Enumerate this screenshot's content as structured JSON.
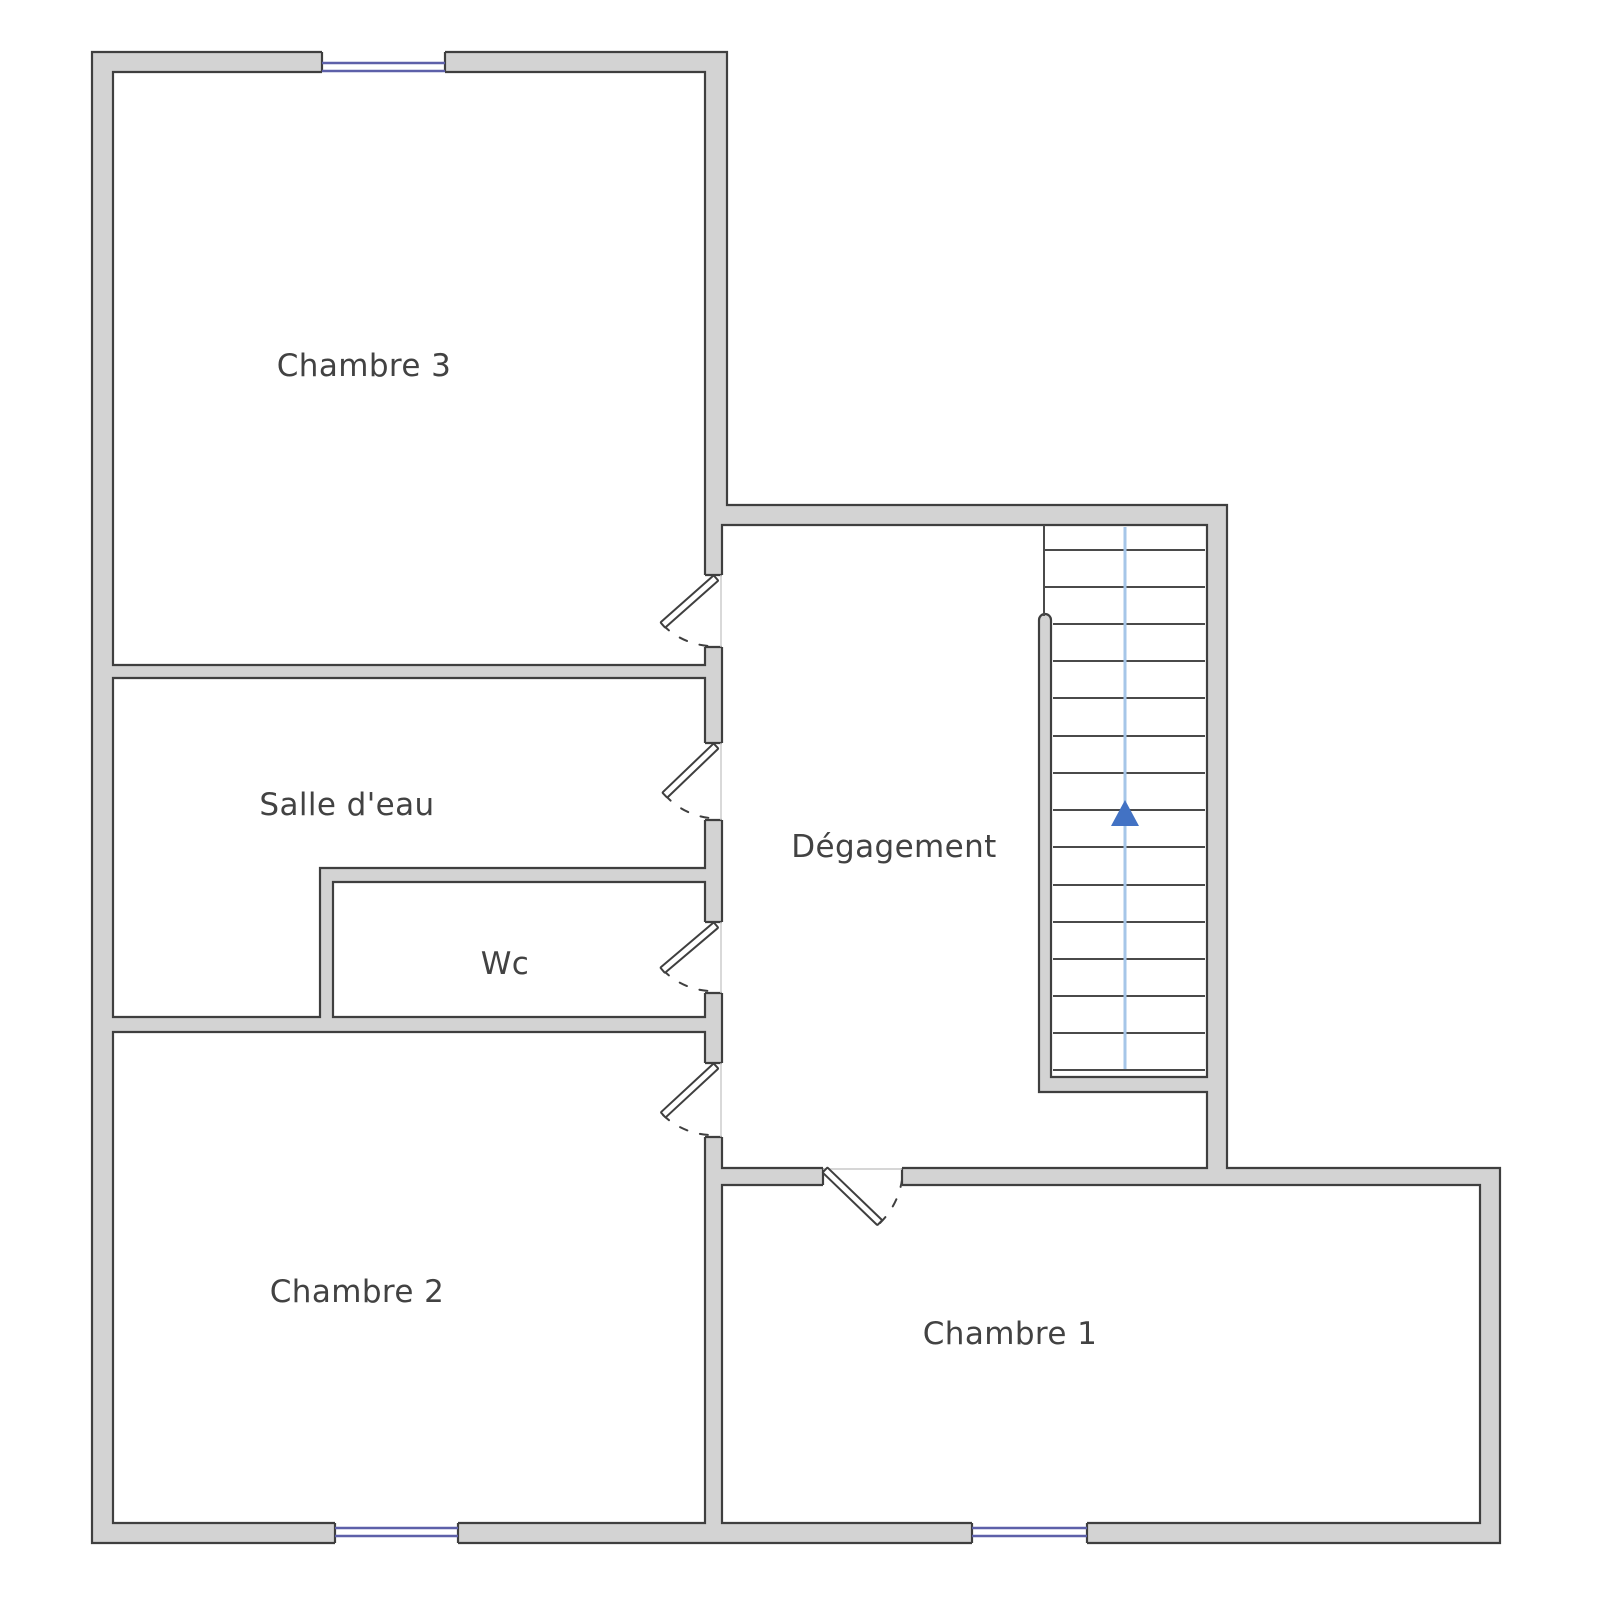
{
  "meta": {
    "title": "Floor plan - upper storey",
    "background": "#ffffff"
  },
  "colors": {
    "wall_fill": "#d3d3d3",
    "wall_stroke": "#3f3f3f",
    "opening_fill": "#ffffff",
    "window_glazing": "#5d60a9",
    "stair_tread": "#4a4a4a",
    "stair_direction_line": "#a6c6e8",
    "stair_arrow": "#4272c4",
    "door_leaf_fill": "#ffffff",
    "door_leaf_stroke": "#3f3f3f",
    "door_arc": "#3f3f3f",
    "faint_face_line": "#c9c9c9",
    "label_text": "#424242"
  },
  "rooms": [
    {
      "id": "chambre-3",
      "label": "Chambre 3",
      "x": 364,
      "y": 366
    },
    {
      "id": "salle-d-eau",
      "label": "Salle d'eau",
      "x": 347,
      "y": 805
    },
    {
      "id": "wc",
      "label": "Wc",
      "x": 505,
      "y": 964
    },
    {
      "id": "degagement",
      "label": "Dégagement",
      "x": 894,
      "y": 847
    },
    {
      "id": "chambre-2",
      "label": "Chambre 2",
      "x": 357,
      "y": 1292
    },
    {
      "id": "chambre-1",
      "label": "Chambre 1",
      "x": 1010,
      "y": 1334
    }
  ],
  "plan": {
    "walls_path": "M92,52 H727 V505 H1227 V1168 H1500 V1543 H92 Z M113,72 H705 V665 H113 Z M113,678 H705 V868 H320 V1017 H113 Z M333,882 H705 V1017 H333 Z M113,1032 H705 V1523 H113 Z M722,525 H1207 V1077 H1051 V620 A6,6 0 0 0 1039,620 V1092 H1207 V1168 H722 Z M722,1185 H1480 V1523 H722 Z",
    "corridor_wall_x": [
      705,
      722
    ],
    "chambre1_wall_y": [
      1168,
      1185
    ],
    "doors": [
      {
        "orient": "v",
        "gap": [
          575,
          647
        ],
        "room": "Chambre 3"
      },
      {
        "orient": "v",
        "gap": [
          743,
          820
        ],
        "room": "Salle d'eau"
      },
      {
        "orient": "v",
        "gap": [
          922,
          993
        ],
        "room": "Wc"
      },
      {
        "orient": "v",
        "gap": [
          1063,
          1137
        ],
        "room": "Chambre 2"
      },
      {
        "orient": "h",
        "gap": [
          823,
          902
        ],
        "room": "Chambre 1"
      }
    ],
    "door_leaves": [
      {
        "hinge": [
          716,
          578
        ],
        "angle": 138.5,
        "length": 71,
        "arc": "M 663 625 A 71 71 0 0 0 710 646"
      },
      {
        "hinge": [
          716,
          746
        ],
        "angle": 136.2,
        "length": 71,
        "arc": "M 665 795 A 70 70 0 0 0 710 818"
      },
      {
        "hinge": [
          716,
          925
        ],
        "angle": 139.7,
        "length": 70,
        "arc": "M 663 970 A 70 70 0 0 0 710 991"
      },
      {
        "hinge": [
          716,
          1066
        ],
        "angle": 137.2,
        "length": 72,
        "arc": "M 663 1115 A 72 72 0 0 0 710 1135"
      },
      {
        "hinge": [
          825,
          1170
        ],
        "angle": 43.9,
        "length": 76,
        "arc": "M 880 1223 A 77 77 0 0 0 902 1180"
      }
    ],
    "windows": [
      {
        "wall": "top",
        "x": [
          322,
          445
        ],
        "y": [
          52,
          72
        ],
        "glaze_y": [
          63,
          71
        ]
      },
      {
        "wall": "bottom",
        "x": [
          335,
          458
        ],
        "y": [
          1523,
          1543
        ],
        "glaze_y": [
          1528,
          1536
        ]
      },
      {
        "wall": "bottom",
        "x": [
          972,
          1087
        ],
        "y": [
          1523,
          1543
        ],
        "glaze_y": [
          1528,
          1536
        ]
      }
    ],
    "stairs": {
      "x": [
        1045,
        1205
      ],
      "top": 525,
      "bottom": 1070,
      "tread_ys": [
        550,
        587,
        624,
        661,
        698,
        736,
        773,
        810,
        847,
        885,
        922,
        959,
        996,
        1033,
        1070
      ],
      "rail_top": 620,
      "rail_side_x": 1053,
      "boundary_line": {
        "x": 1044,
        "y": [
          525,
          616
        ]
      },
      "direction_line": {
        "x": 1125,
        "y": [
          527,
          1069
        ]
      },
      "arrow_points": "1125,800 1111,826 1139,826"
    }
  }
}
